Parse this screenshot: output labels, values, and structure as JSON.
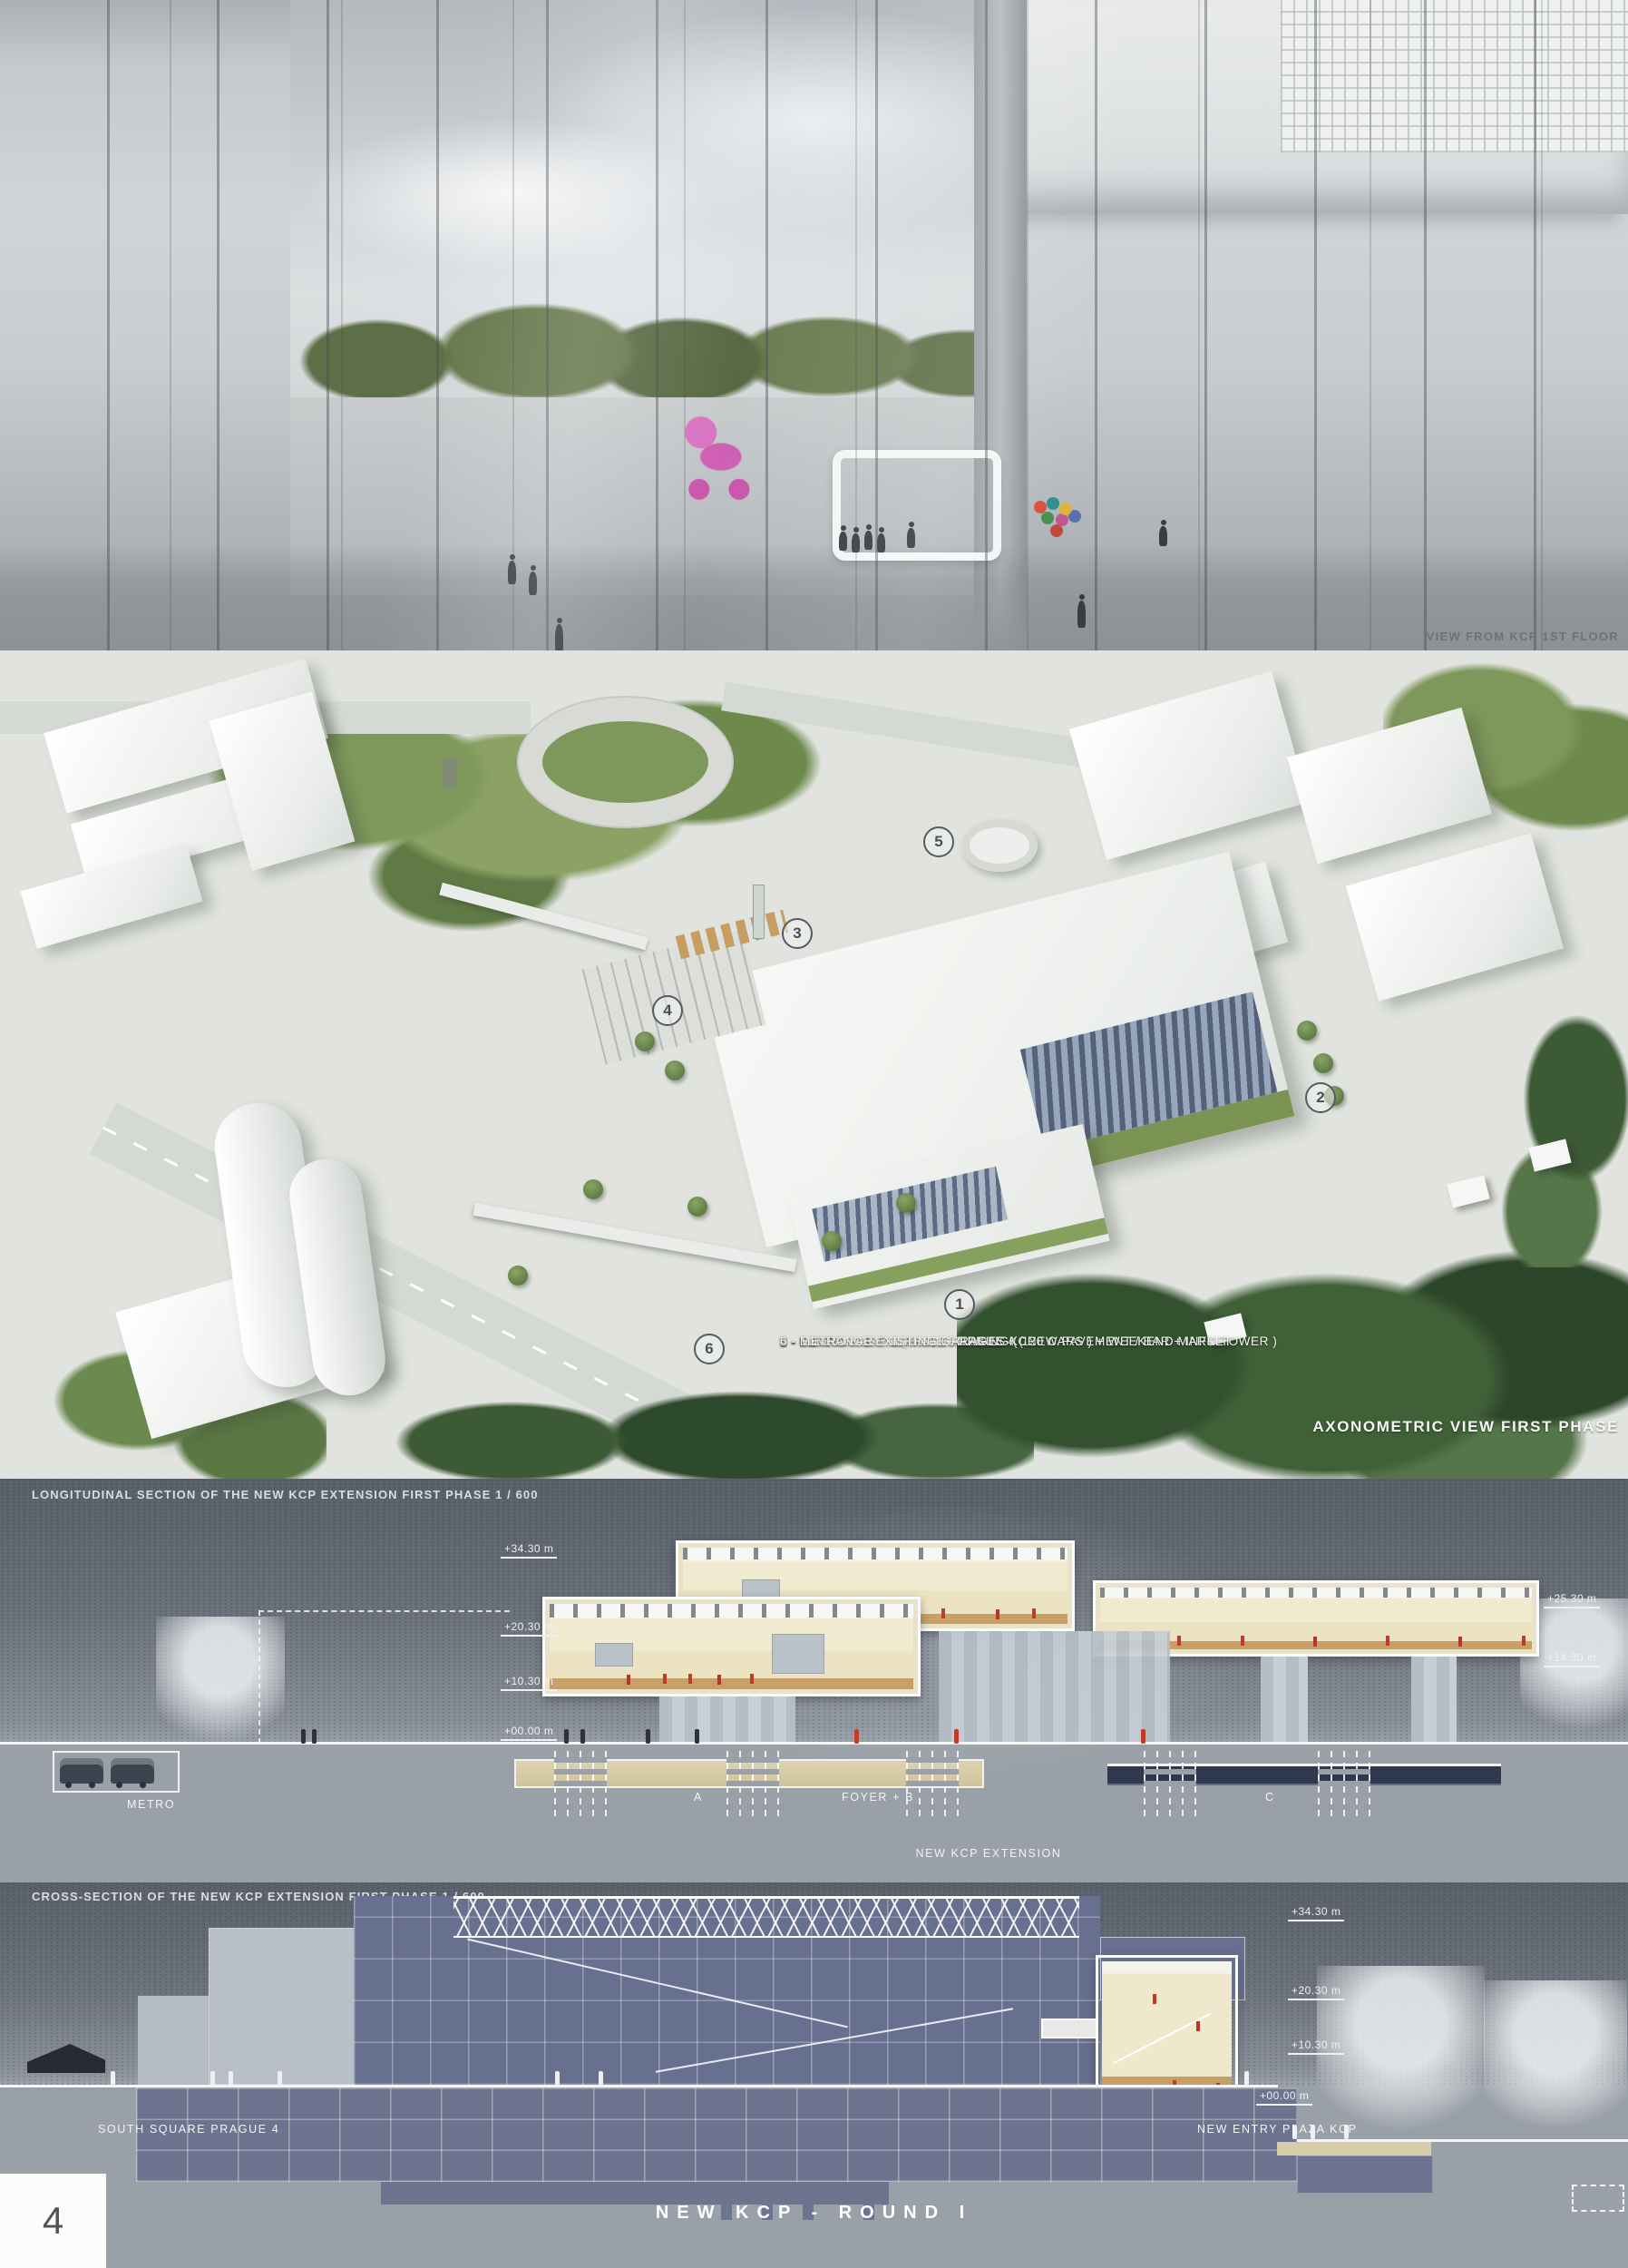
{
  "board": {
    "panel1": {
      "caption": "VIEW FROM KCP 1ST FLOOR"
    },
    "axon": {
      "legend": [
        "1 - NEW EXHIBITION HALL KCP",
        "2 - LOADING BAY EXHIBITION HALL",
        "3 - FIRST PHASE SQUARE PRAGUE 4 ( NEW PAVEMENT / BAR + INFO TOWER )",
        "4 - TEMPORARY SURFACE PARKING ( 120 CARS ) + WEEKEND MARKET",
        "5 - ENTRANCE EXISTING GARAGES KCP",
        "6 - METRO"
      ],
      "caption": "AXONOMETRIC VIEW FIRST PHASE",
      "markers": [
        "1",
        "2",
        "3",
        "4",
        "5",
        "6"
      ]
    },
    "longitudinal": {
      "title": "LONGITUDINAL SECTION OF THE NEW KCP EXTENSION FIRST PHASE   1 / 600",
      "elev": {
        "m3430": "+34.30 m",
        "m2030": "+20.30 m",
        "m1030": "+10.30 m",
        "m0000": "+00.00 m",
        "m2530": "+25.30 m",
        "m1430": "+14.30 m"
      },
      "labels": {
        "metro": "METRO",
        "zone_a": "A",
        "zone_foyer": "FOYER + B",
        "zone_c": "C",
        "extension": "NEW KCP EXTENSION"
      }
    },
    "cross": {
      "title": "CROSS-SECTION OF THE NEW KCP EXTENSION FIRST PHASE   1 / 600",
      "elev": {
        "m3430": "+34.30 m",
        "m2030": "+20.30 m",
        "m1030": "+10.30 m",
        "m0000": "+00.00 m"
      },
      "labels": {
        "south_square": "SOUTH SQUARE PRAGUE 4",
        "entry_plaza": "NEW ENTRY PLAZA KCP"
      }
    },
    "footer": {
      "page_number": "4",
      "board_title": "NEW KCP - ROUND I"
    },
    "palette": {
      "hall_cream": "#f0e9cf",
      "wood_floor": "#c49a62",
      "figure_red": "#c23a28",
      "band_beige": "#d8cda9",
      "band_navy": "#2e3950",
      "blueprint_slate": "#6b7290",
      "legend_text": "#ffffff"
    }
  }
}
